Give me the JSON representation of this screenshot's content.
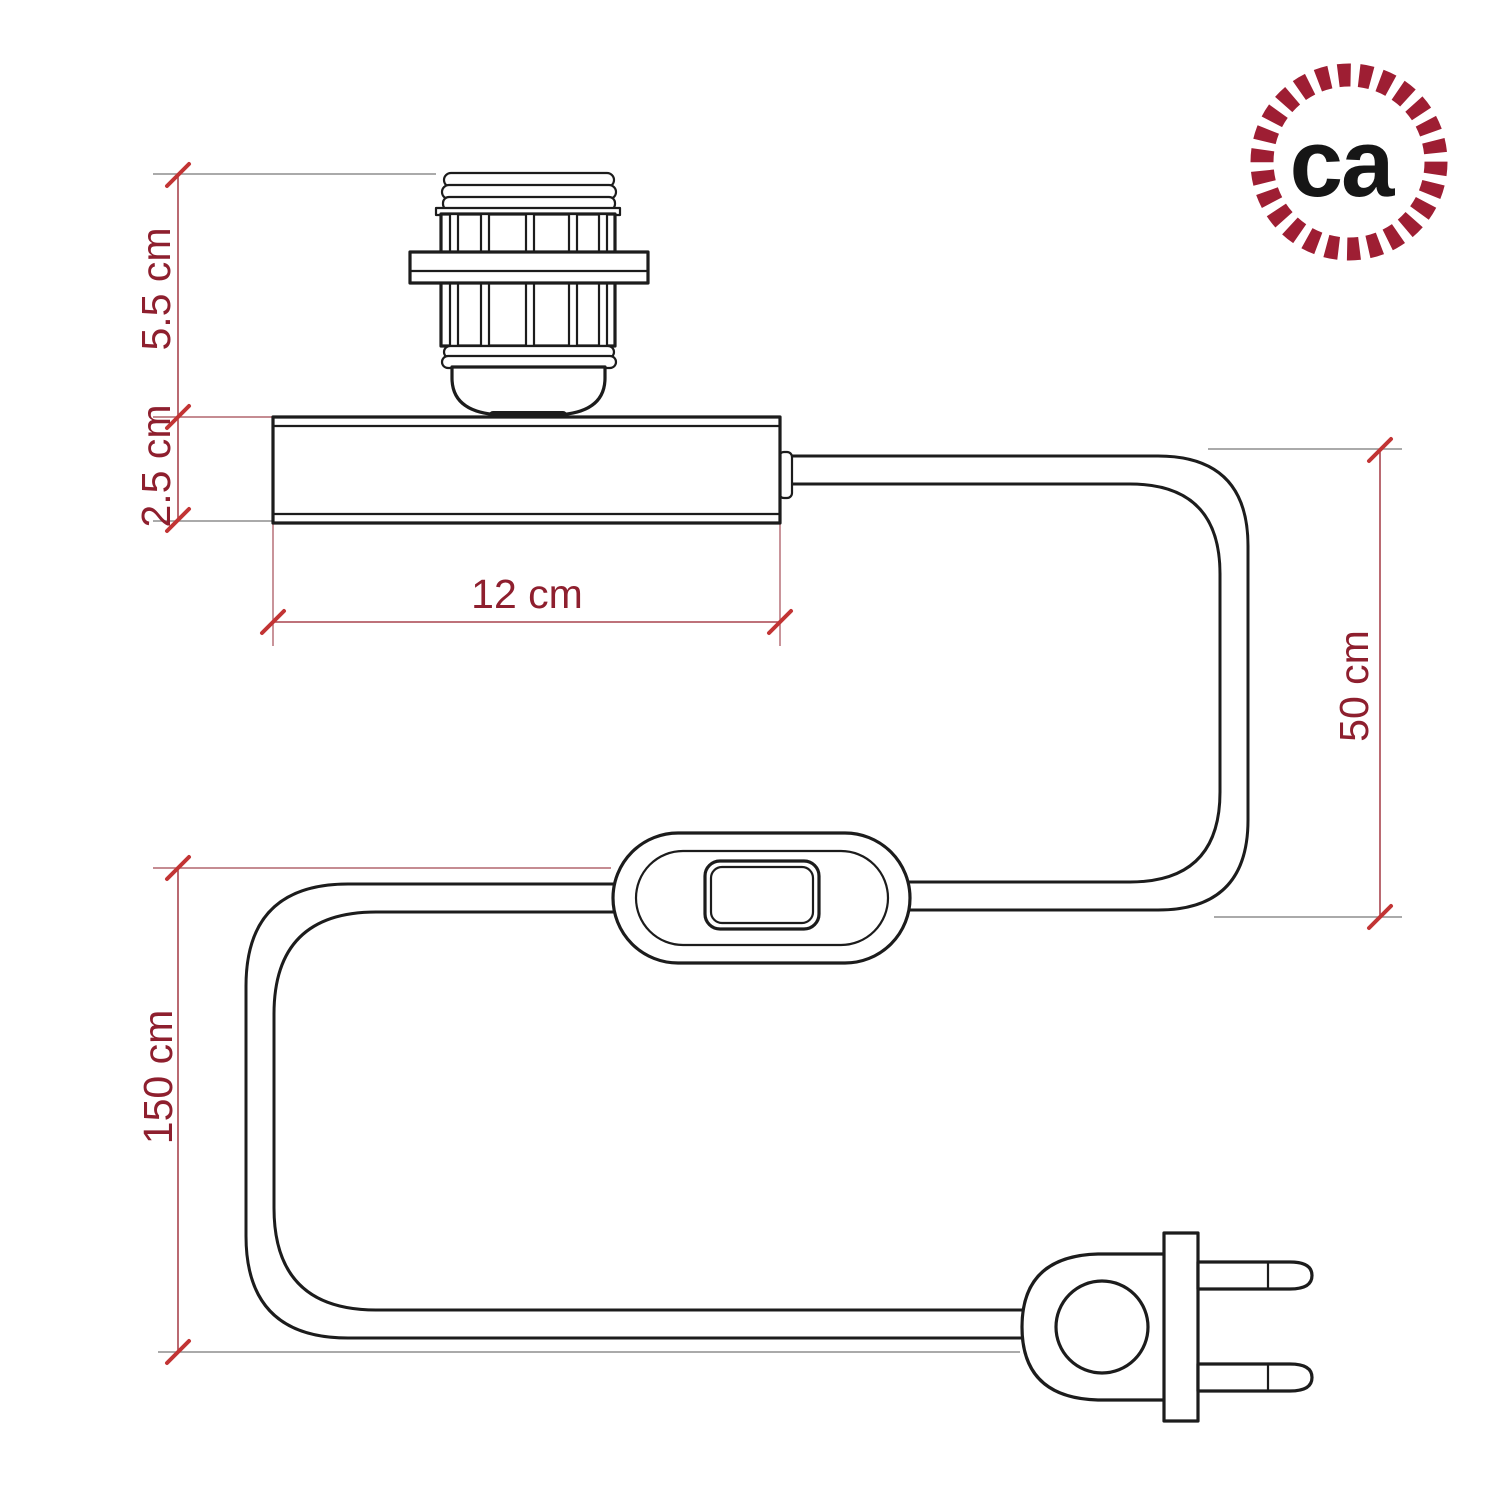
{
  "logo": {
    "text": "ca"
  },
  "dimensions": {
    "socket_height": "5.5 cm",
    "base_height": "2.5 cm",
    "base_width": "12 cm",
    "upper_cable": "50 cm",
    "total_cable": "150 cm"
  },
  "colors": {
    "page_bg": "#ffffff",
    "outline": "#1c1c1c",
    "dimension_line": "#a9444e",
    "extension_gray": "#8d8d8d",
    "extension_red": "#b2666e",
    "tick": "#c23434",
    "dimension_text": "#8e1f2e",
    "logo_ring": "#9e1e33",
    "logo_text": "#161616"
  }
}
